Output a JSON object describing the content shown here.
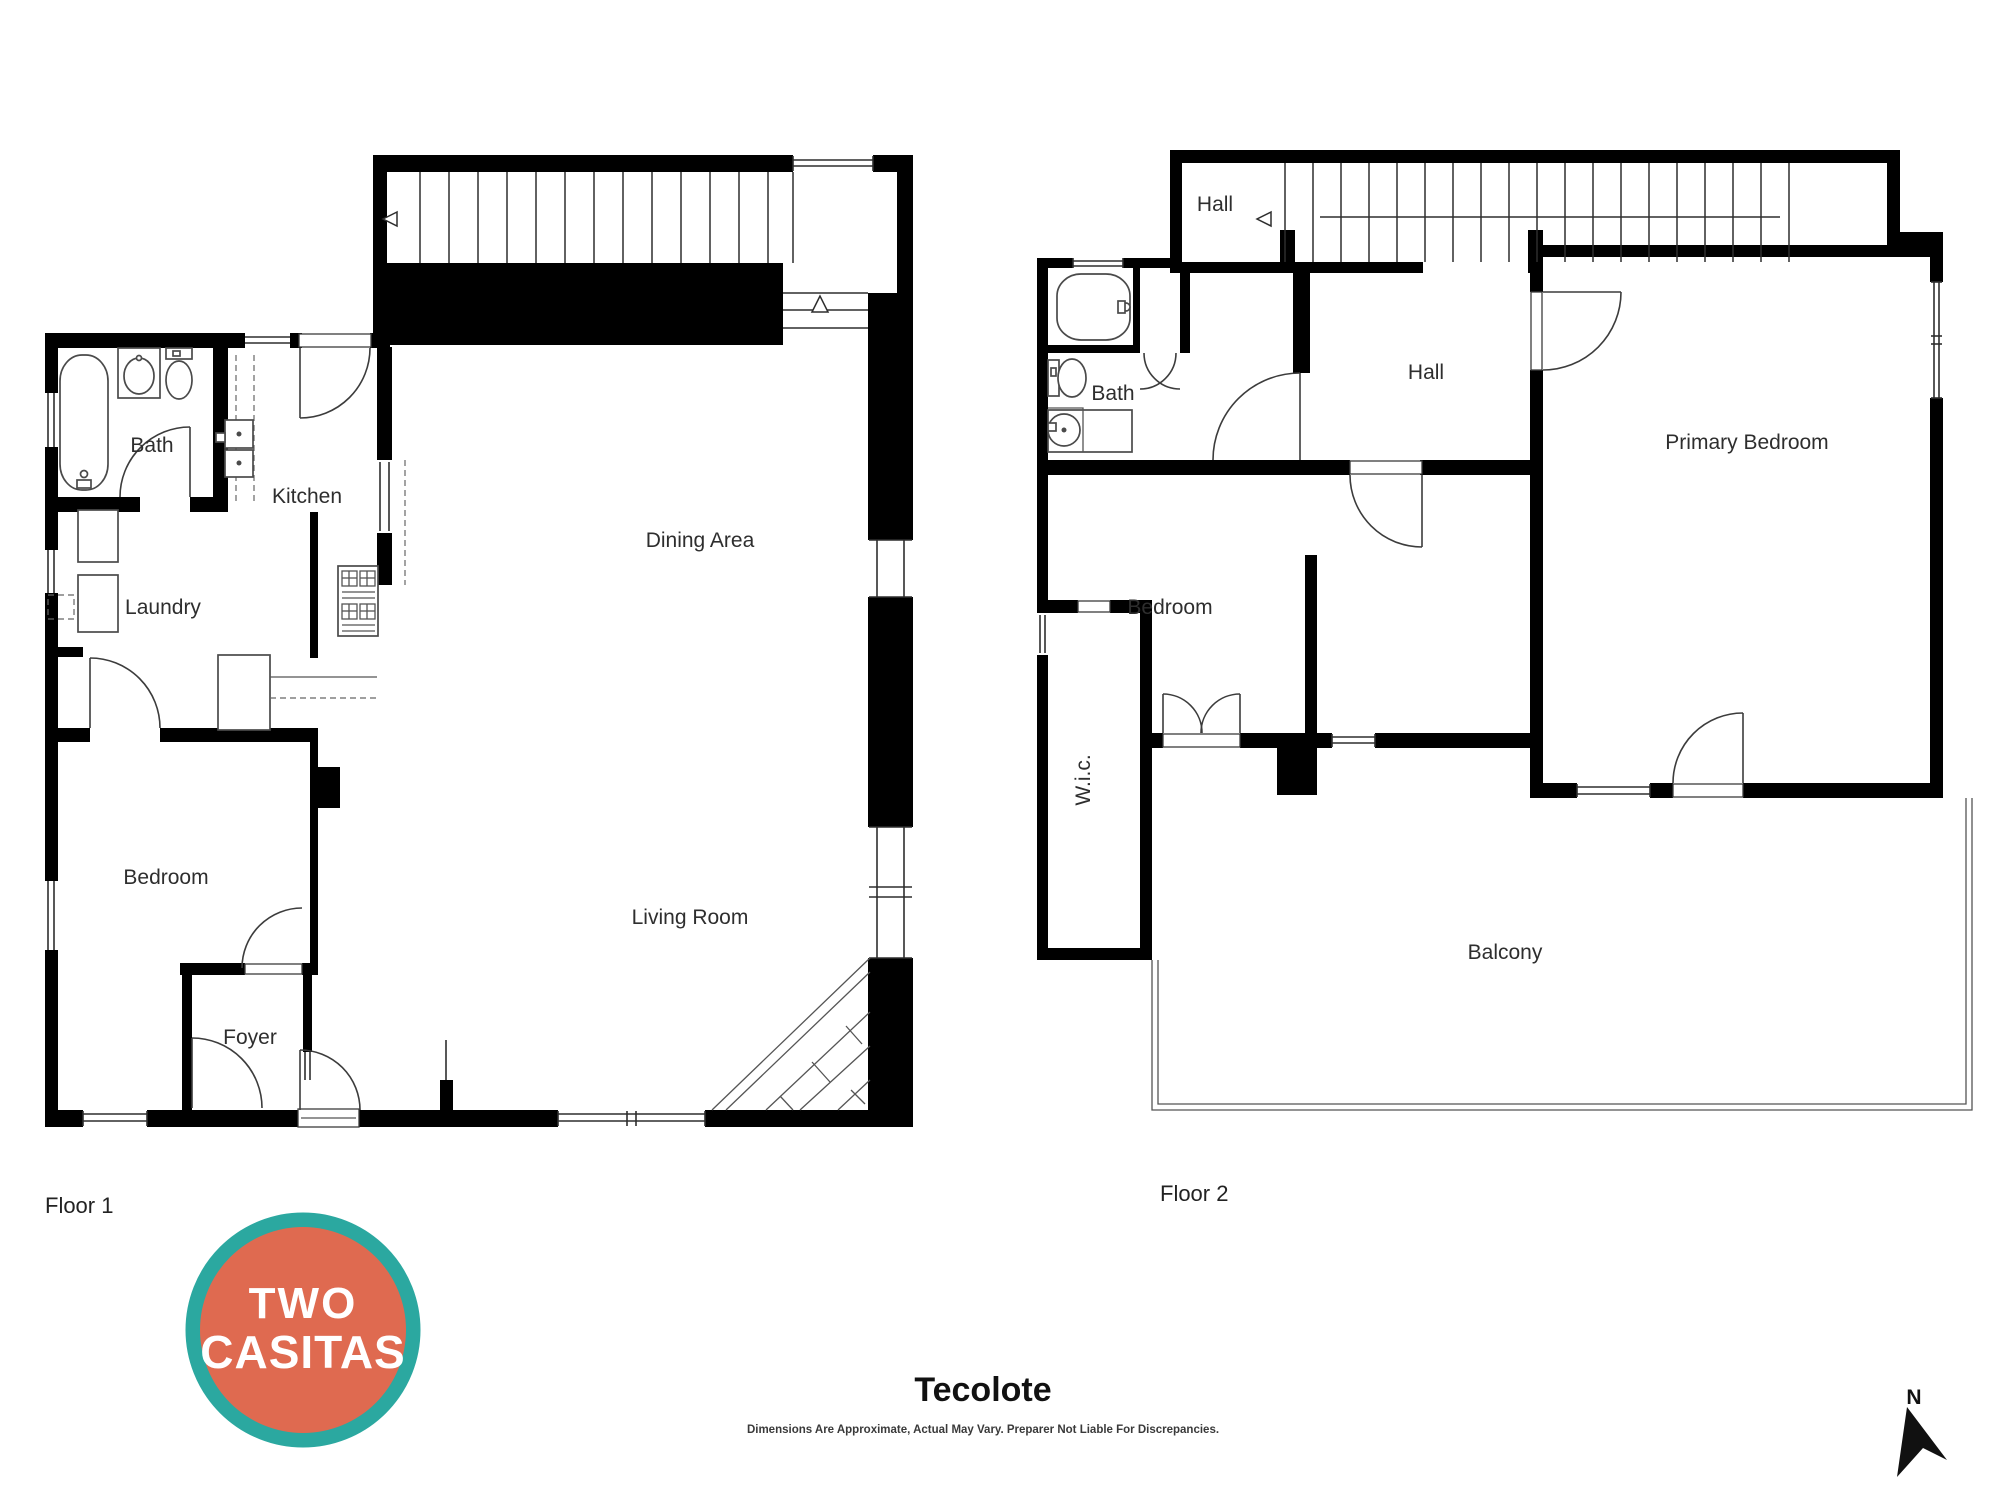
{
  "floor1": {
    "label": "Floor 1",
    "rooms": {
      "bath": "Bath",
      "kitchen": "Kitchen",
      "dining": "Dining Area",
      "laundry": "Laundry",
      "bedroom": "Bedroom",
      "living": "Living Room",
      "foyer": "Foyer"
    }
  },
  "floor2": {
    "label": "Floor 2",
    "rooms": {
      "hall_upper": "Hall",
      "hall": "Hall",
      "bath": "Bath",
      "primary_bedroom": "Primary Bedroom",
      "bedroom": "Bedroom",
      "wic": "W.i.c.",
      "balcony": "Balcony"
    }
  },
  "logo": {
    "line1": "TWO",
    "line2": "CASITAS",
    "ring_color": "#2ba8a0",
    "fill_color": "#df6a50",
    "text_color": "#ffffff"
  },
  "footer": {
    "title": "Tecolote",
    "disclaimer": "Dimensions Are Approximate, Actual May Vary. Preparer Not Liable For Discrepancies."
  },
  "compass": {
    "label": "N"
  },
  "colors": {
    "wall": "#000000",
    "line": "#3c3c3c",
    "text": "#2e2e2e"
  }
}
